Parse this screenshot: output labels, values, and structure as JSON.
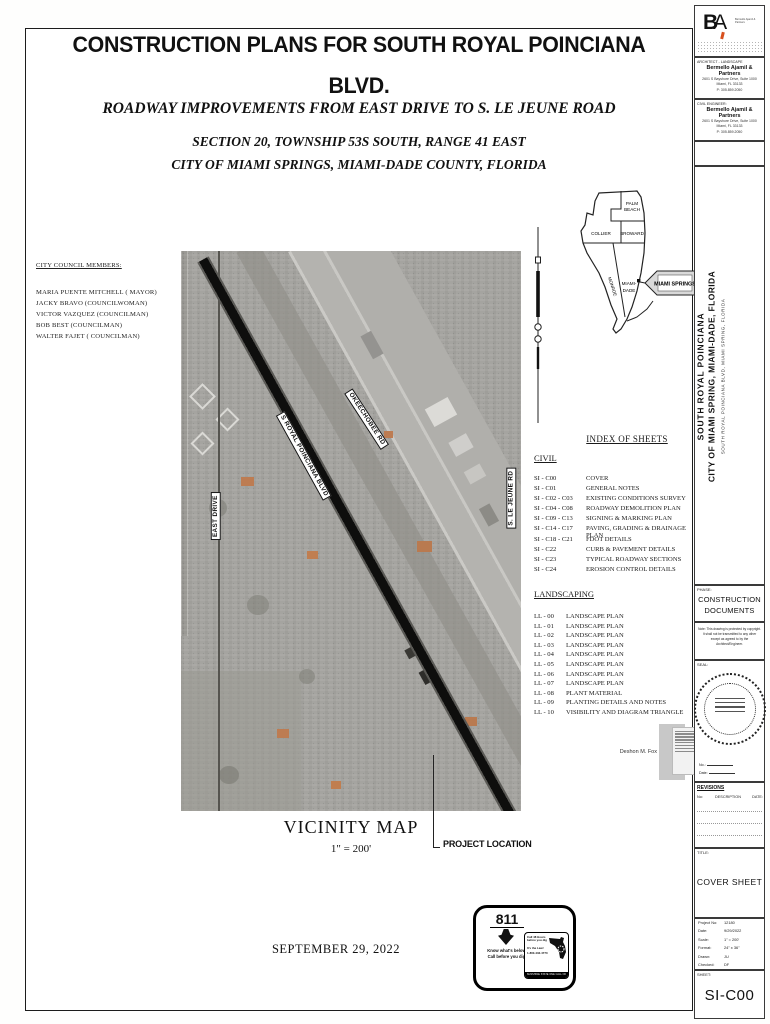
{
  "header": {
    "title_line1": "CONSTRUCTION PLANS FOR SOUTH ROYAL POINCIANA",
    "title_line2": "BLVD.",
    "subtitle": "ROADWAY IMPROVEMENTS FROM EAST DRIVE TO S. LE JEUNE ROAD",
    "section_line1": "SECTION 20, TOWNSHIP 53S SOUTH, RANGE 41 EAST",
    "section_line2": "CITY OF MIAMI SPRINGS, MIAMI-DADE COUNTY, FLORIDA"
  },
  "council": {
    "heading": "CITY COUNCIL MEMBERS:",
    "members": [
      "MARIA PUENTE MITCHELL ( MAYOR)",
      "JACKY BRAVO (COUNCILWOMAN)",
      "VICTOR VAZQUEZ (COUNCILMAN)",
      "BOB BEST (COUNCILMAN)",
      "WALTER FAJET ( COUNCILMAN)"
    ]
  },
  "vicinity": {
    "caption": "VICINITY MAP",
    "scale": "1\" = 200'",
    "project_location": "PROJECT LOCATION",
    "labels": {
      "east_drive": "EAST DRIVE",
      "royal_poinciana": "S ROYAL POINCIANA BLVD",
      "okeechobee": "OKEECHOBEE RD",
      "le_jeune": "S. LE JEUNE RD"
    }
  },
  "florida_map": {
    "palm_beach": "PALM BEACH",
    "broward": "BROWARD",
    "collier": "COLLIER",
    "miami_dade_1": "MIAMI-",
    "miami_dade_2": "DADE",
    "monroe": "MONROE",
    "callout": "MIAMI SPRINGS"
  },
  "index": {
    "heading": "INDEX OF SHEETS",
    "civil_heading": "CIVIL",
    "civil": [
      {
        "no": "SI - C00",
        "title": "COVER"
      },
      {
        "no": "SI - C01",
        "title": "GENERAL NOTES"
      },
      {
        "no": "SI - C02 - C03",
        "title": "EXISTING CONDITIONS SURVEY"
      },
      {
        "no": "SI - C04 - C08",
        "title": "ROADWAY DEMOLITION PLAN"
      },
      {
        "no": "SI - C09 - C13",
        "title": "SIGNING & MARKING PLAN"
      },
      {
        "no": "SI - C14 - C17",
        "title": "PAVING, GRADING & DRAINAGE PLAN"
      },
      {
        "no": "SI - C18 - C21",
        "title": "FDOT DETAILS"
      },
      {
        "no": "SI - C22",
        "title": "CURB & PAVEMENT DETAILS"
      },
      {
        "no": "SI - C23",
        "title": "TYPICAL ROADWAY SECTIONS"
      },
      {
        "no": "SI - C24",
        "title": "EROSION CONTROL DETAILS"
      }
    ],
    "landscaping_heading": "LANDSCAPING",
    "landscaping": [
      {
        "no": "LL - 00",
        "title": "LANDSCAPE PLAN"
      },
      {
        "no": "LL - 01",
        "title": "LANDSCAPE PLAN"
      },
      {
        "no": "LL - 02",
        "title": "LANDSCAPE PLAN"
      },
      {
        "no": "LL - 03",
        "title": "LANDSCAPE PLAN"
      },
      {
        "no": "LL - 04",
        "title": "LANDSCAPE PLAN"
      },
      {
        "no": "LL - 05",
        "title": "LANDSCAPE PLAN"
      },
      {
        "no": "LL - 06",
        "title": "LANDSCAPE PLAN"
      },
      {
        "no": "LL - 07",
        "title": "LANDSCAPE PLAN"
      },
      {
        "no": "LL - 08",
        "title": "PLANT MATERIAL"
      },
      {
        "no": "LL - 09",
        "title": "PLANTING DETAILS AND NOTES"
      },
      {
        "no": "LL - 10",
        "title": "VISIBILITY AND DIAGRAM TRIANGLE"
      }
    ]
  },
  "signature": {
    "name": "Deshon M. Fox"
  },
  "date_line": "SEPTEMBER 29, 2022",
  "call811": {
    "number": "811",
    "tagline1": "Know what's below.",
    "tagline2": "Call before you dig.",
    "panel_line1": "Call 48 Hours",
    "panel_line2": "before you dig",
    "panel_line3": "It's the Law!",
    "panel_line4": "1-800-432-4770",
    "panel_bar": "SUNSHINE STATE ONE CALL OF FLORIDA, INC."
  },
  "titleblock": {
    "logo_b": "B",
    "logo_a": "A",
    "logo_sub": "Bermello Ajamil & Partners",
    "architect_label": "ARCHITECT - LANDSCAPE",
    "architect_firm": "Bermello Ajamil & Partners",
    "architect_addr1": "2601 S Bayshore Drive, Suite 1000",
    "architect_addr2": "Miami, FL 33133",
    "architect_phone": "P: 305.859.2050",
    "engineer_label": "CIVIL ENGINEER:",
    "engineer_firm": "Bermello Ajamil & Partners",
    "engineer_addr1": "2601 S Bayshore Drive, Suite 1000",
    "engineer_addr2": "Miami, FL 33133",
    "engineer_phone": "P: 305.859.2050",
    "project_title1": "SOUTH ROYAL POINCIANA",
    "project_title2": "CITY OF MIAMI SPRING, MIAMI-DADE, FLORIDA",
    "project_subtitle": "SOUTH ROYAL POINCIANA BLVD, MIAMI SPRING, FLORIDA",
    "phase_label": "PHASE:",
    "phase_value1": "CONSTRUCTION",
    "phase_value2": "DOCUMENTS",
    "note": "Note: This drawing is protected by copyright. It shall not be transmitted to any other except as agreed to by the Architect/Engineer.",
    "seal_label": "SEAL:",
    "seal_no_label": "No.:",
    "seal_date_label": "Date:",
    "revisions_label": "REVISIONS",
    "rev_no": "No:",
    "rev_desc": "DESCRIPTION",
    "rev_date": "DATE:",
    "title_label": "TITLE:",
    "sheet_title": "COVER SHEET",
    "info": [
      {
        "label": "Project No:",
        "value": "12180"
      },
      {
        "label": "Date:",
        "value": "9/29/2022"
      },
      {
        "label": "Scale:",
        "value": "1\" = 200'"
      },
      {
        "label": "Format:",
        "value": "24\" x 36\""
      },
      {
        "label": "Drawn:",
        "value": "JU"
      },
      {
        "label": "Checked:",
        "value": "DF"
      }
    ],
    "sheet_label": "SHEET:",
    "sheet_no": "SI-C00"
  }
}
